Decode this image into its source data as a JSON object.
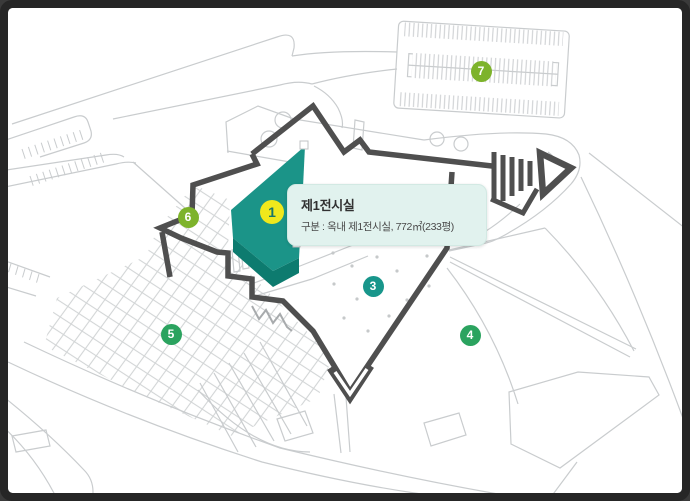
{
  "tooltip": {
    "title": "제1전시실",
    "description": "구분 : 옥내 제1전시실, 772㎡(233평)"
  },
  "markers": [
    {
      "number": "1",
      "x": 272,
      "y": 212,
      "size": 24,
      "bg": "#f0e81c",
      "fg": "#17756a",
      "selected": true
    },
    {
      "number": "3",
      "x": 373,
      "y": 286,
      "size": 21,
      "bg": "#18968b",
      "fg": "#ffffff",
      "selected": false
    },
    {
      "number": "4",
      "x": 470,
      "y": 335,
      "size": 21,
      "bg": "#2ba35f",
      "fg": "#ffffff",
      "selected": false
    },
    {
      "number": "5",
      "x": 171,
      "y": 334,
      "size": 21,
      "bg": "#2ba35f",
      "fg": "#ffffff",
      "selected": false
    },
    {
      "number": "6",
      "x": 188,
      "y": 217,
      "size": 21,
      "bg": "#7db32b",
      "fg": "#ffffff",
      "selected": false
    },
    {
      "number": "7",
      "x": 481,
      "y": 71,
      "size": 21,
      "bg": "#7db32b",
      "fg": "#ffffff",
      "selected": false
    }
  ],
  "colors": {
    "frame": "#262626",
    "map_background": "#ffffff",
    "map_lines": "#c9ccce",
    "building_outline": "#4f4f4f",
    "highlight_building": "#1b9488",
    "highlight_building_side": "#0d7b6f",
    "tooltip_background": "#e1f2ee",
    "marker_selected_yellow": "#f0e81c",
    "marker_teal": "#18968b",
    "marker_green": "#2ba35f",
    "marker_olive": "#7db32b"
  }
}
